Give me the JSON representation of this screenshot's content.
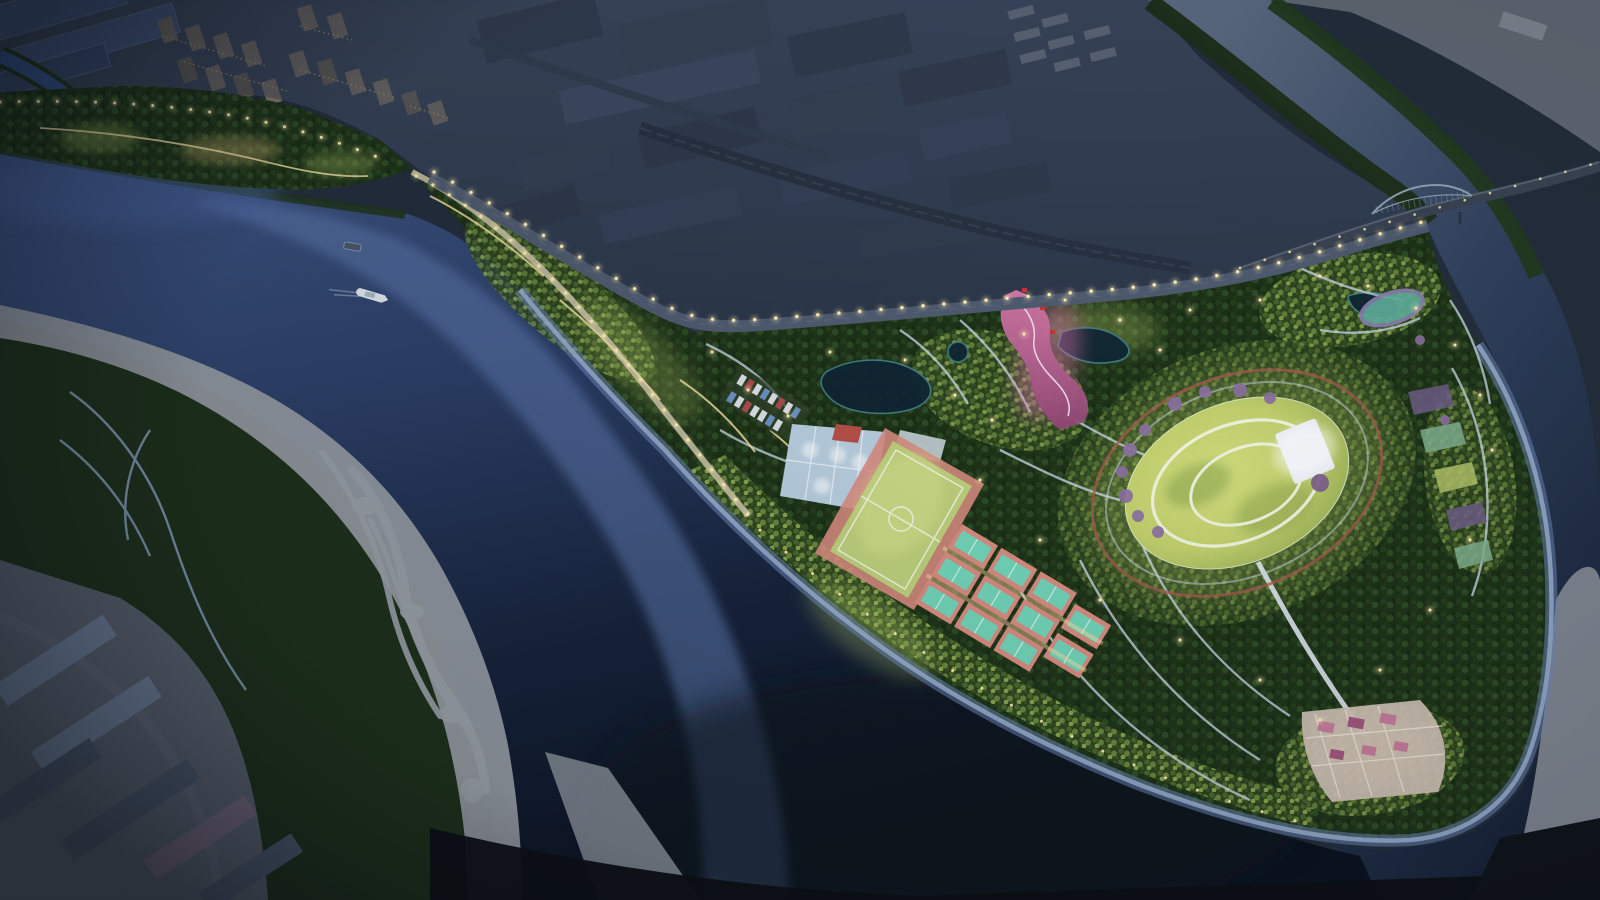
{
  "scene": {
    "subject": "riverside-peninsula-park-masterplan",
    "setting": "night-aerial-rendering",
    "features": [
      "city blocks and warehouses along the top",
      "truss bridge over river at top right",
      "illuminated embankment roads with street lights",
      "sports zone: blue courts, soccer field, tennis courts",
      "great oval lawn with concentric paths and stage",
      "pink illuminated entry plaza",
      "terraced tip plaza at the south-east point",
      "braided river shoals and sandbars bottom left",
      "boats on the river"
    ]
  },
  "palette": {
    "base_night": "#232d3b",
    "water_shallow": "#5d78ad",
    "sandbar": "#979ca4",
    "channel_gray": "#7b828c",
    "floodplain": "#1d2f1a",
    "industrial_ground": "#57606e",
    "slab_light": "#6b7c96",
    "slab_dark": "#49556a",
    "slab_mauve": "#70657a",
    "creek_blue": "#33518a",
    "bridge_deck": "#3a4352",
    "bridge_truss": "#8ba3b0",
    "highway": "#4e5a6e",
    "embankment": "#c6bfa4",
    "walkway_shore": "#6a84b4",
    "path_warm": "#ecd9a0",
    "path_cool": "#ccdaec",
    "light_glow": "#ffedb0",
    "court_blue": "#b5cbdc",
    "court_red": "#b24f48",
    "court_teal": "#6fd0b5",
    "court_salmon": "#d4897e",
    "field_green": "#b9cc79",
    "field_line": "#eef2e2",
    "track_red": "#a65a4c",
    "ring_white": "#eef2e2",
    "stage_white": "#e9eef6",
    "blossom_purple": "#8a6fa0",
    "bed_teal": "#5fae9a",
    "bed_ring": "#8a7fae",
    "tip_plaza": "#cdbfb4",
    "boat_white": "#dfe7ee",
    "boat_dark": "#49566a",
    "glow_lime": "#b8cf6a",
    "glow_magenta": "#d470a8",
    "glow_warm": "#ffd98a",
    "window_amber": "#d9ab66"
  }
}
